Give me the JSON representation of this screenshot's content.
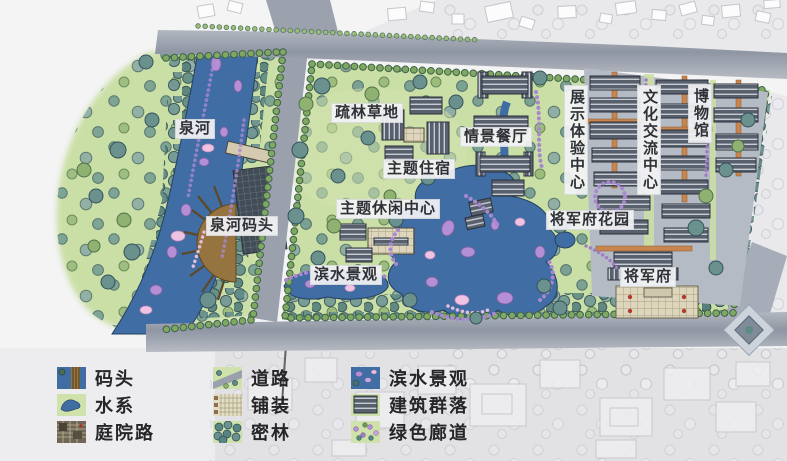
{
  "map": {
    "labels": [
      {
        "id": "quanhe",
        "text": "泉河"
      },
      {
        "id": "quanhe-dock",
        "text": "泉河码头"
      },
      {
        "id": "sparse-woodland",
        "text": "疏林草地"
      },
      {
        "id": "scene-restaurant",
        "text": "情景餐厅"
      },
      {
        "id": "theme-lodging",
        "text": "主题住宿"
      },
      {
        "id": "theme-leisure-center",
        "text": "主题休闲中心"
      },
      {
        "id": "waterfront-landscape",
        "text": "滨水景观"
      },
      {
        "id": "exhibition-experience-center",
        "text": "展示体验中心"
      },
      {
        "id": "culture-exchange-center",
        "text": "文化交流中心"
      },
      {
        "id": "museum",
        "text": "博物馆"
      },
      {
        "id": "general-mansion-garden",
        "text": "将军府花园"
      },
      {
        "id": "general-mansion",
        "text": "将军府"
      }
    ]
  },
  "legend": {
    "items": [
      {
        "label": "码头",
        "swatch": "dock"
      },
      {
        "label": "水系",
        "swatch": "water"
      },
      {
        "label": "庭院路",
        "swatch": "courtyard-path"
      },
      {
        "label": "道路",
        "swatch": "road"
      },
      {
        "label": "铺装",
        "swatch": "paving"
      },
      {
        "label": "密林",
        "swatch": "dense-forest"
      },
      {
        "label": "滨水景观",
        "swatch": "waterfront"
      },
      {
        "label": "建筑群落",
        "swatch": "building-cluster"
      },
      {
        "label": "绿色廊道",
        "swatch": "green-corridor"
      }
    ]
  },
  "colors": {
    "water": "#3f6da4",
    "grass": "#cadfa6",
    "road": "#9aa1ad",
    "roof": "#59606d",
    "path_orange": "#c9854e",
    "shrub_purple": "#b48fd6",
    "tree_teal": "#64908c",
    "tree_green": "#8fb273",
    "label_bg": "#f3f3f5",
    "label_text": "#2e3136"
  }
}
